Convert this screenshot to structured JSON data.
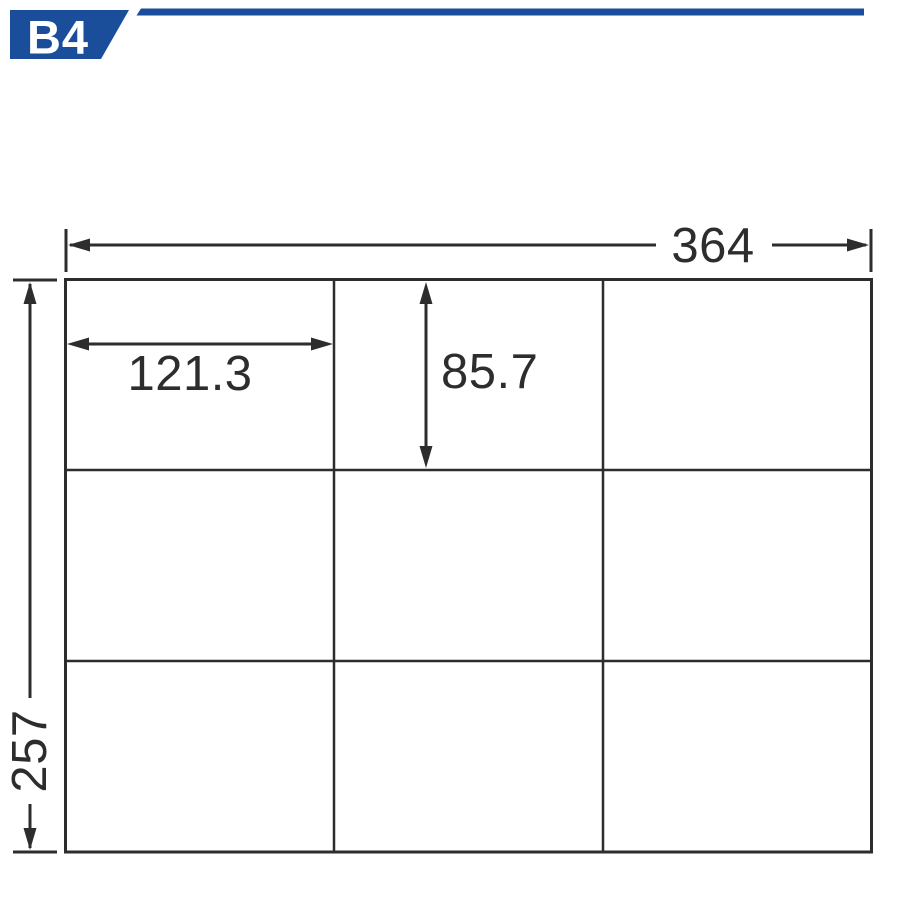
{
  "page": {
    "background_color": "#ffffff"
  },
  "header": {
    "badge": {
      "label": "B4",
      "bg_color": "#1a4e9b",
      "text_color": "#ffffff"
    },
    "rule_color": "#1a4e9b"
  },
  "diagram": {
    "line_color": "#2d2d2d",
    "text_color": "#2d2d2d",
    "sheet": {
      "total_width": "364",
      "total_height": "257",
      "cell_width": "121.3",
      "cell_height": "85.7",
      "rows": 3,
      "columns": 3
    }
  }
}
